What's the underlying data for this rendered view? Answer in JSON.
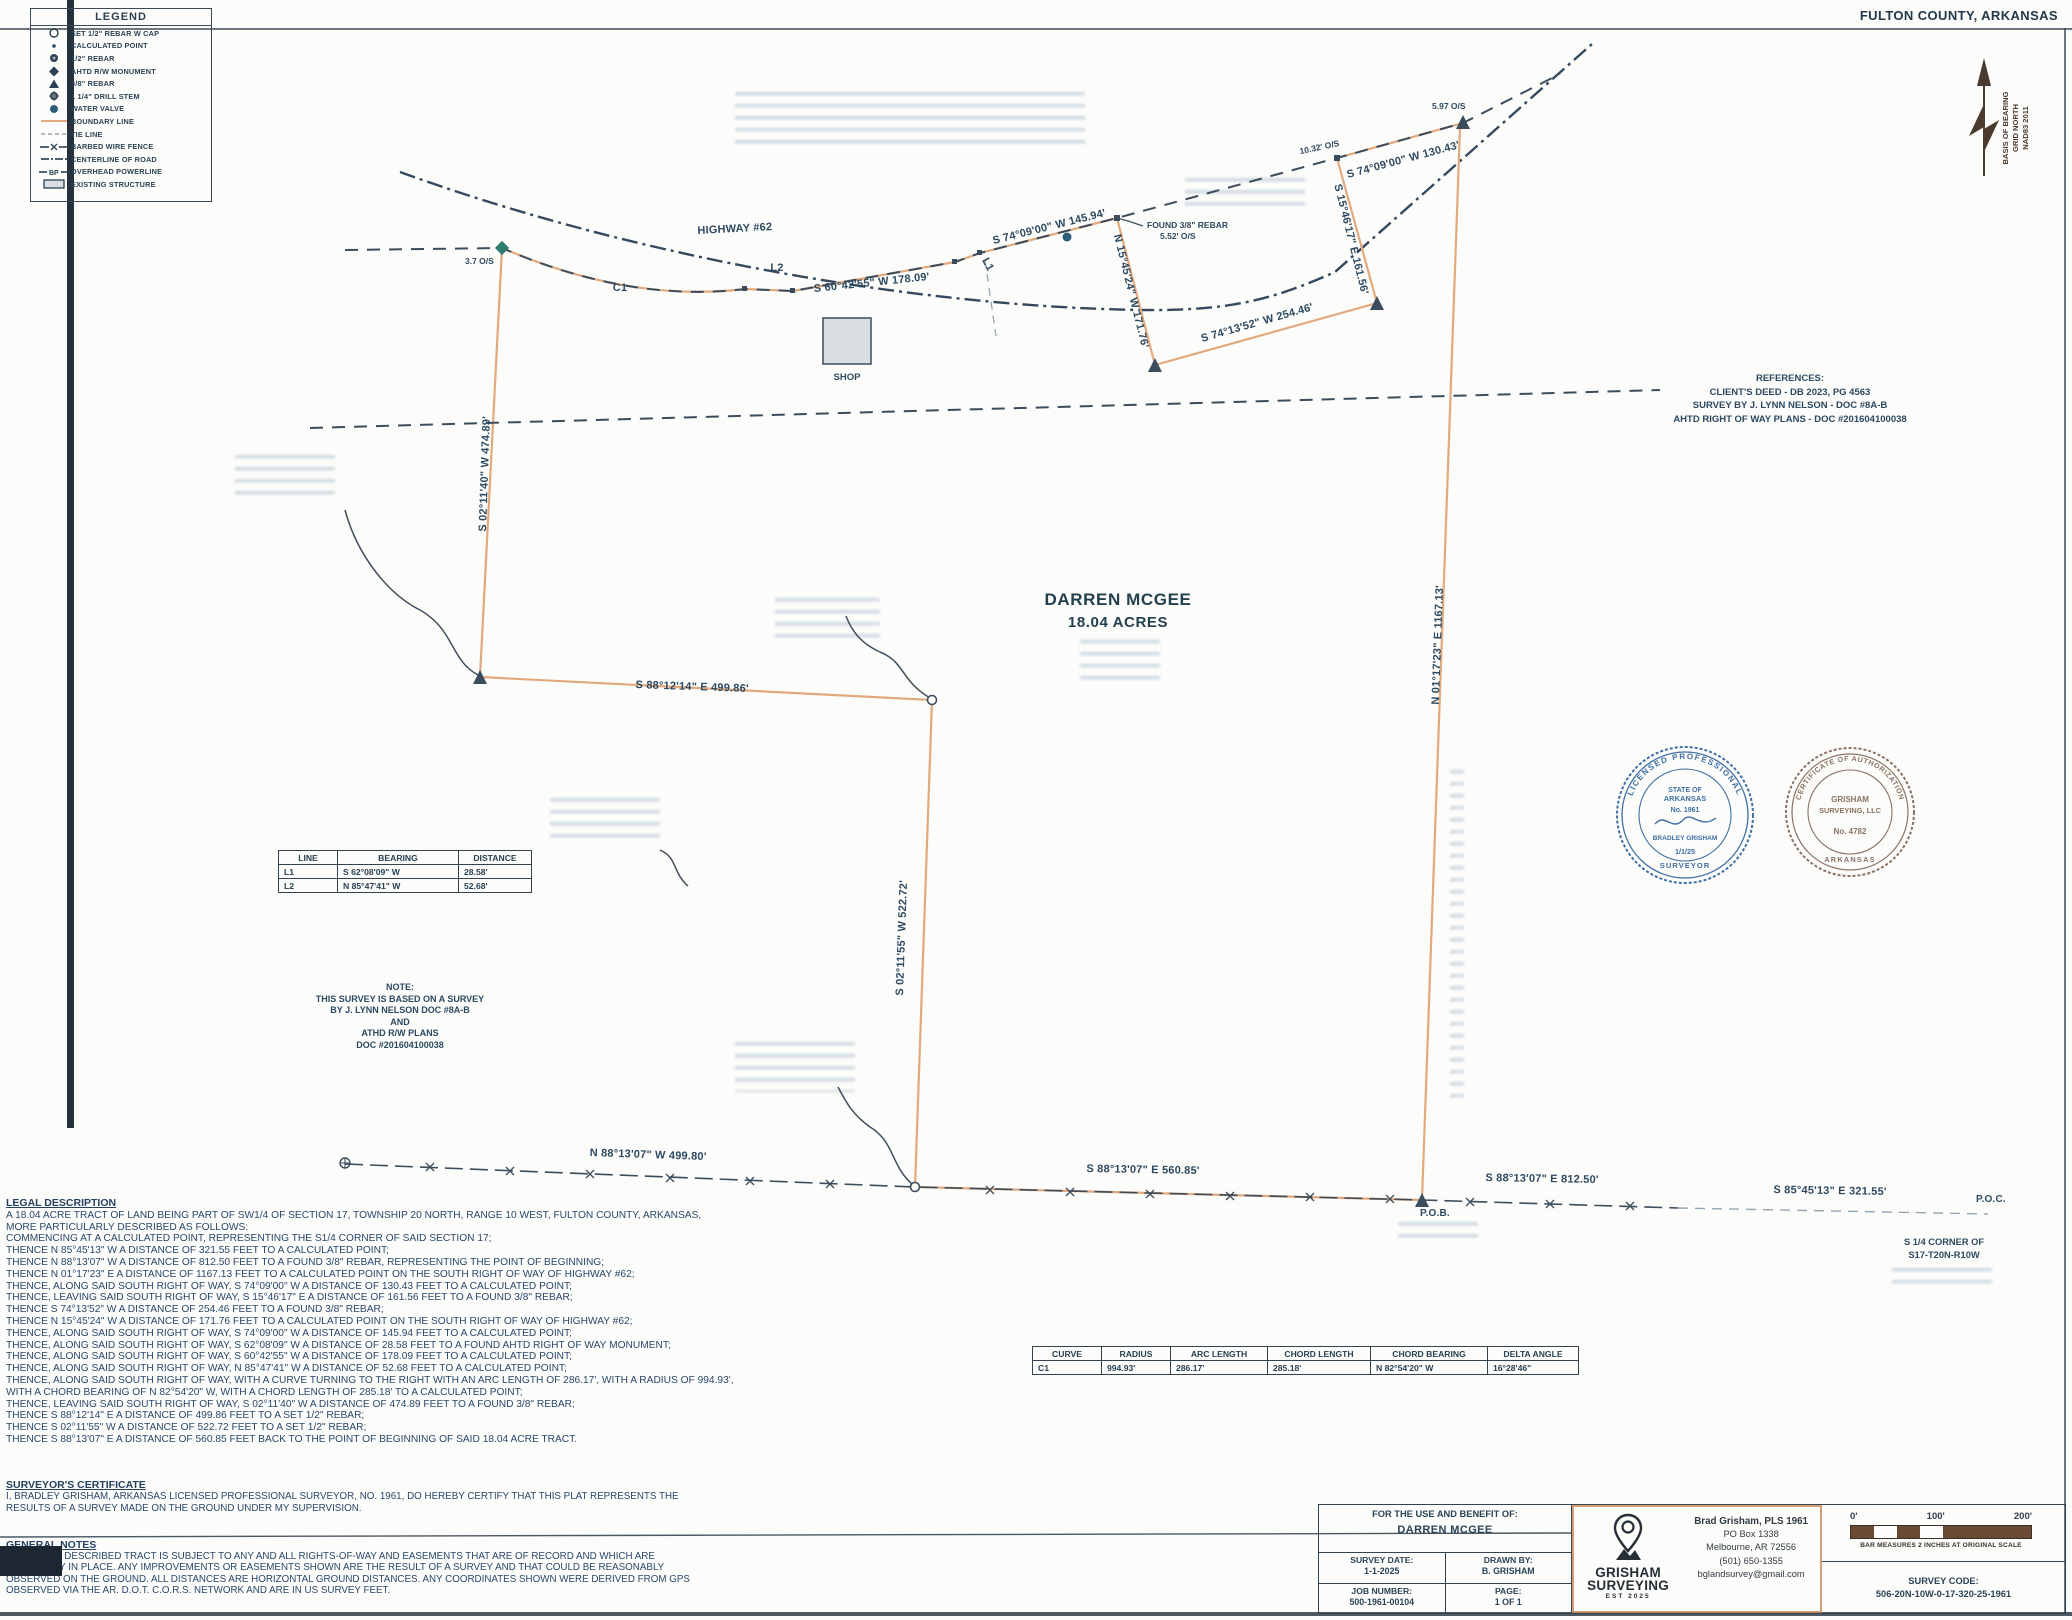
{
  "page": {
    "county": "FULTON COUNTY, ARKANSAS"
  },
  "north": {
    "line1": "BASIS OF BEARING",
    "line2": "GRID NORTH",
    "line3": "NAD83 2011"
  },
  "legend": {
    "title": "LEGEND",
    "bp": "BP",
    "items": [
      {
        "label": "SET 1/2\" REBAR W CAP"
      },
      {
        "label": "CALCULATED POINT"
      },
      {
        "label": "1/2\" REBAR"
      },
      {
        "label": "AHTD R/W MONUMENT"
      },
      {
        "label": "3/8\" REBAR"
      },
      {
        "label": "1 1/4\" DRILL STEM"
      },
      {
        "label": "WATER VALVE"
      },
      {
        "label": "BOUNDARY LINE"
      },
      {
        "label": "TIE LINE"
      },
      {
        "label": "BARBED WIRE FENCE"
      },
      {
        "label": "CENTERLINE OF ROAD"
      },
      {
        "label": "OVERHEAD POWERLINE"
      },
      {
        "label": "EXISTING STRUCTURE"
      }
    ]
  },
  "plat": {
    "highway": "HIGHWAY #62",
    "c1": "C1",
    "l1": "L1",
    "l2": "L2",
    "brg_s6042": "S 60°42'55\" W 178.09'",
    "brg_s7409_145": "S 74°09'00\" W 145.94'",
    "found_rebar1": "FOUND 3/8\" REBAR",
    "found_rebar2": "5.52' O/S",
    "os_37": "3.7 O/S",
    "os_1032": "10.32' O/S",
    "os_597": "5.97 O/S",
    "brg_s7409_130": "S 74°09'00\" W 130.43'",
    "brg_s1546": "S 15°46'17\" E 161.56'",
    "brg_s7413": "S 74°13'52\" W 254.46'",
    "brg_n1545": "N 15°45'24\" W 171.76'",
    "brg_s0211_474": "S 02°11'40\" W 474.89'",
    "brg_s8812": "S 88°12'14\" E 499.86'",
    "brg_s0211_522": "S 02°11'55\" W 522.72'",
    "brg_n0117": "N 01°17'23\" E 1167.13'",
    "brg_n8813": "N 88°13'07\" W 499.80'",
    "brg_s8813_560": "S 88°13'07\" E 560.85'",
    "brg_s8813_812": "S 88°13'07\" E 812.50'",
    "brg_s8545": "S 85°45'13\" E 321.55'",
    "pob": "P.O.B.",
    "poc": "P.O.C.",
    "corner1": "S 1/4 CORNER OF",
    "corner2": "S17-T20N-R10W",
    "shop": "SHOP",
    "owner": "DARREN MCGEE",
    "acres": "18.04 ACRES"
  },
  "references": {
    "title": "REFERENCES:",
    "lines": [
      "CLIENT'S DEED - DB 2023, PG 4563",
      "SURVEY BY J. LYNN NELSON - DOC #8A-B",
      "AHTD RIGHT OF WAY PLANS - DOC #201604100038"
    ]
  },
  "note": {
    "lines": [
      "NOTE:",
      "THIS SURVEY IS BASED ON A SURVEY",
      "BY J. LYNN NELSON DOC #8A-B",
      "AND",
      "ATHD R/W PLANS",
      "DOC #201604100038"
    ]
  },
  "line_table": {
    "headers": [
      "LINE",
      "BEARING",
      "DISTANCE"
    ],
    "rows": [
      [
        "L1",
        "S 62°08'09\" W",
        "28.58'"
      ],
      [
        "L2",
        "N 85°47'41\" W",
        "52.68'"
      ]
    ]
  },
  "curve_table": {
    "headers": [
      "CURVE",
      "RADIUS",
      "ARC LENGTH",
      "CHORD LENGTH",
      "CHORD BEARING",
      "DELTA ANGLE"
    ],
    "rows": [
      [
        "C1",
        "994.93'",
        "286.17'",
        "285.18'",
        "N 82°54'20\" W",
        "16°28'46\""
      ]
    ]
  },
  "legal": {
    "title": "LEGAL DESCRIPTION",
    "lines": [
      "A 18.04 ACRE TRACT OF LAND BEING PART OF SW1/4 OF SECTION 17, TOWNSHIP 20 NORTH, RANGE 10 WEST, FULTON COUNTY, ARKANSAS,",
      "MORE PARTICULARLY DESCRIBED AS FOLLOWS:",
      "COMMENCING AT A CALCULATED POINT, REPRESENTING THE S1/4 CORNER OF SAID SECTION 17;",
      "THENCE N 85°45'13\" W A DISTANCE OF 321.55 FEET TO A CALCULATED POINT;",
      "THENCE N 88°13'07\" W A DISTANCE OF 812.50 FEET TO A FOUND 3/8\" REBAR, REPRESENTING THE POINT OF BEGINNING;",
      "THENCE N 01°17'23\" E A DISTANCE OF 1167.13 FEET TO A CALCULATED POINT ON THE SOUTH RIGHT OF WAY OF HIGHWAY #62;",
      "THENCE, ALONG SAID SOUTH RIGHT OF WAY, S 74°09'00\" W A DISTANCE OF 130.43 FEET TO A CALCULATED POINT;",
      "THENCE, LEAVING SAID SOUTH RIGHT OF WAY, S 15°46'17\" E A DISTANCE OF 161.56 FEET TO A FOUND 3/8\" REBAR;",
      "THENCE S 74°13'52\" W A DISTANCE OF 254.46 FEET TO A FOUND 3/8\" REBAR;",
      "THENCE N 15°45'24\" W A DISTANCE OF 171.76 FEET TO A CALCULATED POINT ON THE SOUTH RIGHT OF WAY OF HIGHWAY #62;",
      "THENCE, ALONG SAID SOUTH RIGHT OF WAY, S 74°09'00\" W A DISTANCE OF 145.94 FEET TO A CALCULATED POINT;",
      "THENCE, ALONG SAID SOUTH RIGHT OF WAY, S 62°08'09\" W A DISTANCE OF 28.58 FEET TO A FOUND AHTD RIGHT OF WAY MONUMENT;",
      "THENCE, ALONG SAID SOUTH RIGHT OF WAY, S 60°42'55\" W A DISTANCE OF 178.09 FEET TO A CALCULATED POINT;",
      "THENCE, ALONG SAID SOUTH RIGHT OF WAY, N 85°47'41\" W A DISTANCE OF 52.68 FEET TO A CALCULATED POINT;",
      "THENCE, ALONG SAID SOUTH RIGHT OF WAY, WITH A CURVE TURNING TO THE RIGHT WITH AN ARC LENGTH OF 286.17', WITH A RADIUS OF 994.93',",
      "WITH A CHORD BEARING OF N 82°54'20\" W, WITH A CHORD LENGTH OF 285.18' TO A CALCULATED POINT;",
      "THENCE, LEAVING SAID SOUTH RIGHT OF WAY, S 02°11'40\" W A DISTANCE OF 474.89 FEET TO A FOUND 3/8\" REBAR;",
      "THENCE S 88°12'14\" E A DISTANCE OF 499.86 FEET TO A SET 1/2\" REBAR;",
      "THENCE S 02°11'55\" W A DISTANCE OF 522.72 FEET TO A SET 1/2\" REBAR;",
      "THENCE S 88°13'07\" E A DISTANCE OF 560.85 FEET BACK TO THE POINT OF BEGINNING OF SAID 18.04 ACRE TRACT."
    ]
  },
  "surveyor_certificate": {
    "title": "SURVEYOR'S CERTIFICATE",
    "lines": [
      "I, BRADLEY GRISHAM, ARKANSAS LICENSED PROFESSIONAL SURVEYOR, NO. 1961, DO HEREBY CERTIFY THAT THIS PLAT REPRESENTS THE",
      "RESULTS OF A SURVEY MADE ON THE GROUND UNDER MY SUPERVISION."
    ]
  },
  "general_notes": {
    "title": "GENERAL NOTES",
    "lines": [
      "THE ABOVE DESCRIBED TRACT IS SUBJECT TO ANY AND ALL RIGHTS-OF-WAY AND EASEMENTS THAT ARE OF RECORD AND WHICH ARE",
      "PHYSICALLY IN PLACE. ANY IMPROVEMENTS OR EASEMENTS SHOWN ARE THE RESULT OF A SURVEY AND THAT COULD BE REASONABLY",
      "OBSERVED ON THE GROUND. ALL DISTANCES ARE HORIZONTAL GROUND DISTANCES. ANY COORDINATES SHOWN WERE DERIVED FROM GPS",
      "OBSERVED VIA THE AR. D.O.T. C.O.R.S. NETWORK AND ARE IN US SURVEY FEET."
    ]
  },
  "seals": {
    "left": {
      "ring_top": "LICENSED PROFESSIONAL",
      "ring_bottom": "SURVEYOR",
      "state1": "STATE OF",
      "state2": "ARKANSAS",
      "number": "No. 1961",
      "name": "BRADLEY GRISHAM",
      "date": "1/1/25"
    },
    "right": {
      "ring_top": "CERTIFICATE OF AUTHORIZATION",
      "ring_bottom": "ARKANSAS",
      "line1": "GRISHAM",
      "line2": "SURVEYING, LLC",
      "number": "No. 4782"
    }
  },
  "title_block": {
    "benefit_label": "FOR THE USE AND BENEFIT OF:",
    "benefit_name": "DARREN MCGEE",
    "survey_date_label": "SURVEY DATE:",
    "survey_date": "1-1-2025",
    "drawn_by_label": "DRAWN BY:",
    "drawn_by": "B. GRISHAM",
    "job_label": "JOB NUMBER:",
    "job": "500-1961-00104",
    "page_label": "PAGE:",
    "page": "1 OF 1",
    "firm1": "GRISHAM",
    "firm2": "SURVEYING",
    "firm_est": "EST  2025",
    "contact1": "Brad Grisham, PLS 1961",
    "contact2": "PO Box 1338",
    "contact3": "Melbourne, AR 72556",
    "contact4": "(501) 650-1355",
    "contact5": "bglandsurvey@gmail.com",
    "scale0": "0'",
    "scale100": "100'",
    "scale200": "200'",
    "scale_note": "BAR MEASURES 2 INCHES AT ORIGINAL SCALE",
    "survey_code_label": "SURVEY CODE:",
    "survey_code": "506-20N-10W-0-17-320-25-1961"
  },
  "colors": {
    "boundary": "#e2a97e",
    "ink": "#33424f",
    "seal_blue": "#3f6fa5",
    "seal_brown": "#8a7263"
  }
}
